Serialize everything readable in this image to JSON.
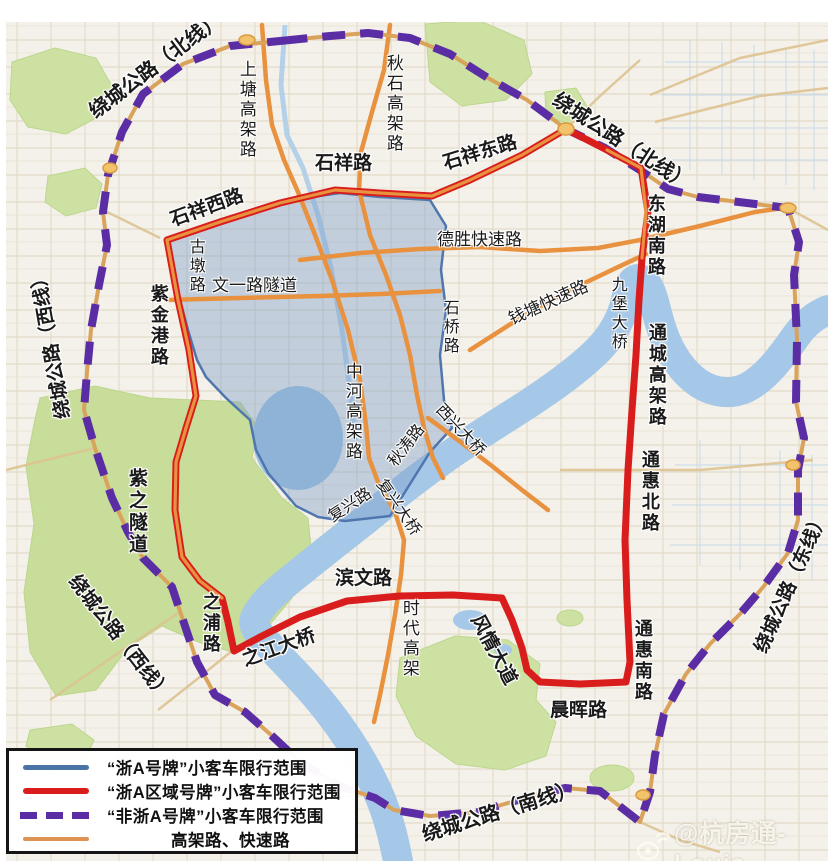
{
  "map": {
    "region_names": {
      "blue_zone": "“浙A号牌”小客车限行范围",
      "red_loop": "“浙A区域号牌”小客车限行范围",
      "purple_ring": "“非浙A号牌”小客车限行范围"
    },
    "labels": [
      {
        "id": "raocheng-north-west",
        "text": "绕城公路（北线）",
        "x": 86,
        "y": 106,
        "rot": -37,
        "vert": false,
        "bold": true,
        "size": 20
      },
      {
        "id": "raocheng-north-east",
        "text": "绕城公路（北线）",
        "x": 560,
        "y": 90,
        "rot": 33,
        "vert": false,
        "bold": true,
        "size": 20
      },
      {
        "id": "raocheng-west-upper",
        "text": "绕城公路（西线）",
        "x": 55,
        "y": 420,
        "rot": -100,
        "vert": false,
        "bold": true,
        "size": 19
      },
      {
        "id": "raocheng-west-lower",
        "text": "绕城公路（西线）",
        "x": 80,
        "y": 572,
        "rot": 52,
        "vert": false,
        "bold": true,
        "size": 19
      },
      {
        "id": "raocheng-east",
        "text": "绕城公路（东线）",
        "x": 752,
        "y": 648,
        "rot": -66,
        "vert": false,
        "bold": true,
        "size": 19
      },
      {
        "id": "raocheng-south",
        "text": "绕城公路（南线）",
        "x": 420,
        "y": 826,
        "rot": -17,
        "vert": false,
        "bold": true,
        "size": 20
      },
      {
        "id": "shixiang-west",
        "text": "石祥西路",
        "x": 168,
        "y": 212,
        "rot": -20,
        "vert": false,
        "bold": true,
        "size": 19
      },
      {
        "id": "shixiang",
        "text": "石祥路",
        "x": 315,
        "y": 154,
        "rot": 0,
        "vert": false,
        "bold": true,
        "size": 19
      },
      {
        "id": "shixiang-east",
        "text": "石祥东路",
        "x": 441,
        "y": 155,
        "rot": -17,
        "vert": false,
        "bold": true,
        "size": 19
      },
      {
        "id": "shangtang-viaduct",
        "text": "上塘高架路",
        "x": 237,
        "y": 60,
        "rot": 0,
        "vert": true,
        "bold": false,
        "size": 17
      },
      {
        "id": "qiushi-viaduct",
        "text": "秋石高架路",
        "x": 384,
        "y": 54,
        "rot": 0,
        "vert": true,
        "bold": false,
        "size": 17
      },
      {
        "id": "gudun",
        "text": "古墩路",
        "x": 186,
        "y": 238,
        "rot": 0,
        "vert": true,
        "bold": false,
        "size": 16
      },
      {
        "id": "wenyi-tunnel",
        "text": "文一路隧道",
        "x": 212,
        "y": 277,
        "rot": 0,
        "vert": false,
        "bold": false,
        "size": 17
      },
      {
        "id": "zijingang",
        "text": "紫金港路",
        "x": 149,
        "y": 284,
        "rot": 0,
        "vert": true,
        "bold": true,
        "size": 18
      },
      {
        "id": "desheng-expwy",
        "text": "德胜快速路",
        "x": 437,
        "y": 231,
        "rot": 0,
        "vert": false,
        "bold": false,
        "size": 17
      },
      {
        "id": "qiantang-expwy",
        "text": "钱塘快速路",
        "x": 506,
        "y": 312,
        "rot": -24,
        "vert": false,
        "bold": false,
        "size": 17
      },
      {
        "id": "shiqiao",
        "text": "石桥路",
        "x": 440,
        "y": 299,
        "rot": 0,
        "vert": true,
        "bold": false,
        "size": 16
      },
      {
        "id": "donghu-south",
        "text": "东湖南路",
        "x": 646,
        "y": 194,
        "rot": 0,
        "vert": true,
        "bold": true,
        "size": 18
      },
      {
        "id": "jiubao-bridge",
        "text": "九堡大桥",
        "x": 608,
        "y": 276,
        "rot": 0,
        "vert": true,
        "bold": false,
        "size": 16
      },
      {
        "id": "tongcheng-viaduct",
        "text": "通城高架路",
        "x": 647,
        "y": 323,
        "rot": 0,
        "vert": true,
        "bold": true,
        "size": 18
      },
      {
        "id": "tonghui-north",
        "text": "通惠北路",
        "x": 640,
        "y": 450,
        "rot": 0,
        "vert": true,
        "bold": true,
        "size": 18
      },
      {
        "id": "tonghui-south",
        "text": "通惠南路",
        "x": 633,
        "y": 619,
        "rot": 0,
        "vert": true,
        "bold": true,
        "size": 18
      },
      {
        "id": "zhonghe-viaduct",
        "text": "中河高架路",
        "x": 343,
        "y": 362,
        "rot": 0,
        "vert": true,
        "bold": false,
        "size": 17
      },
      {
        "id": "qiutao",
        "text": "秋涛路",
        "x": 386,
        "y": 460,
        "rot": -52,
        "vert": false,
        "bold": false,
        "size": 16
      },
      {
        "id": "xixing-bridge",
        "text": "西兴大桥",
        "x": 444,
        "y": 402,
        "rot": 47,
        "vert": false,
        "bold": false,
        "size": 16
      },
      {
        "id": "fuxing-road",
        "text": "复兴路",
        "x": 326,
        "y": 512,
        "rot": -33,
        "vert": false,
        "bold": false,
        "size": 16
      },
      {
        "id": "fuxing-bridge",
        "text": "复兴大桥",
        "x": 386,
        "y": 477,
        "rot": 55,
        "vert": false,
        "bold": false,
        "size": 16
      },
      {
        "id": "binwen",
        "text": "滨文路",
        "x": 335,
        "y": 569,
        "rot": 0,
        "vert": false,
        "bold": true,
        "size": 19
      },
      {
        "id": "shidai-viaduct",
        "text": "时代高架",
        "x": 400,
        "y": 599,
        "rot": 0,
        "vert": true,
        "bold": false,
        "size": 17
      },
      {
        "id": "fengqing-avenue",
        "text": "风情大道",
        "x": 484,
        "y": 612,
        "rot": 62,
        "vert": false,
        "bold": true,
        "size": 19
      },
      {
        "id": "chenhui",
        "text": "晨晖路",
        "x": 550,
        "y": 701,
        "rot": 0,
        "vert": false,
        "bold": true,
        "size": 19
      },
      {
        "id": "zhipu",
        "text": "之浦路",
        "x": 201,
        "y": 592,
        "rot": 0,
        "vert": true,
        "bold": true,
        "size": 18
      },
      {
        "id": "zhijiang-bridge",
        "text": "之江大桥",
        "x": 240,
        "y": 652,
        "rot": -20,
        "vert": false,
        "bold": true,
        "size": 19
      },
      {
        "id": "zizhi-tunnel",
        "text": "紫之隧道",
        "x": 126,
        "y": 468,
        "rot": 0,
        "vert": true,
        "bold": true,
        "size": 19
      }
    ]
  },
  "legend": {
    "items": [
      {
        "swatch": "blue-solid-line",
        "label": "“浙A号牌”小客车限行范围"
      },
      {
        "swatch": "red-solid-line",
        "label": "“浙A区域号牌”小客车限行范围"
      },
      {
        "swatch": "purple-dashed-line",
        "label": "“非浙A号牌”小客车限行范围"
      },
      {
        "swatch": "orange-solid-line",
        "label": "高架路、快速路"
      }
    ]
  },
  "watermark": {
    "handle": "@杭房通-Louis",
    "icon": "weibo-icon"
  },
  "colors": {
    "restriction_blue": "#4a74a8",
    "restriction_red": "#d91c1c",
    "non_zhea_purple": "#5b2da5",
    "expressway_orange": "#e8913e",
    "water": "#a6c8e8",
    "park_green": "#cde2a2"
  }
}
